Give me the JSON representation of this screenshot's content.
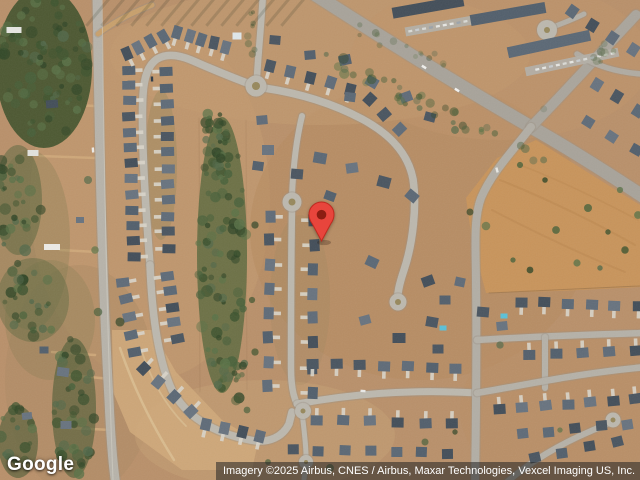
{
  "map": {
    "view": "satellite",
    "pin": {
      "x": 321,
      "y": 242,
      "body_color": "#E8453C",
      "border_color": "#C0291F",
      "dot_color": "#8C1D12"
    }
  },
  "branding": {
    "logo_text": "Google"
  },
  "attribution": {
    "text": "Imagery ©2025 Airbus, CNES / Airbus, Maxar Technologies, Vexcel Imaging US, Inc.",
    "bar_color": "rgba(38,38,38,0.56)",
    "text_color": "#ffffff"
  }
}
